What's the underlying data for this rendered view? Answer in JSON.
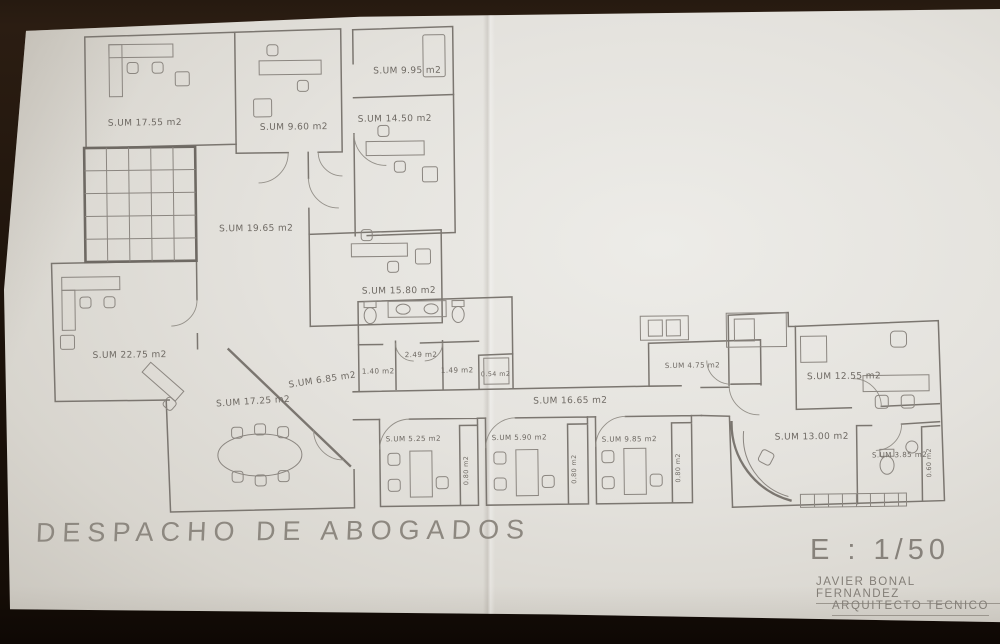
{
  "plan": {
    "title": "DESPACHO DE ABOGADOS",
    "scale": "E : 1/50",
    "author": "JAVIER BONAL FERNANDEZ",
    "author_title": "ARQUITECTO TECNICO",
    "line_color": "#7b7670",
    "paper_color": "#e4e2dd",
    "background_color": "#1d130b",
    "rooms": [
      {
        "id": "office-top-left",
        "label": "S.UM 17.55 m2"
      },
      {
        "id": "office-top-mid",
        "label": "S.UM 9.60 m2"
      },
      {
        "id": "office-top-right",
        "label": "S.UM 9.95 m2"
      },
      {
        "id": "office-mid-right",
        "label": "S.UM 14.50 m2"
      },
      {
        "id": "central-hall",
        "label": "S.UM 19.65 m2"
      },
      {
        "id": "office-center",
        "label": "S.UM 15.80 m2"
      },
      {
        "id": "office-left",
        "label": "S.UM 22.75 m2"
      },
      {
        "id": "meeting-room",
        "label": "S.UM 17.25 m2"
      },
      {
        "id": "small-office",
        "label": "S.UM 6.85 m2"
      },
      {
        "id": "wc-lobby",
        "label": "2.49 m2"
      },
      {
        "id": "wc-left",
        "label": "1.40 m2"
      },
      {
        "id": "wc-right",
        "label": "1.49 m2"
      },
      {
        "id": "closet",
        "label": "0.54 m2"
      },
      {
        "id": "corridor",
        "label": "S.UM 16.65 m2"
      },
      {
        "id": "cubicle-1",
        "label": "S.UM 5.25 m2"
      },
      {
        "id": "cubicle-1-closet",
        "label": "0.80 m2"
      },
      {
        "id": "cubicle-2",
        "label": "S.UM 5.90 m2"
      },
      {
        "id": "cubicle-2-closet",
        "label": "0.80 m2"
      },
      {
        "id": "cubicle-3",
        "label": "S.UM 9.85 m2"
      },
      {
        "id": "cubicle-3-closet",
        "label": "0.80 m2"
      },
      {
        "id": "storage",
        "label": "S.UM 4.75 m2"
      },
      {
        "id": "office-right",
        "label": "S.UM 12.55 m2"
      },
      {
        "id": "reception",
        "label": "S.UM 13.00 m2"
      },
      {
        "id": "wc-reception",
        "label": "S.UM 3.85 m2"
      },
      {
        "id": "reception-closet",
        "label": "0.60 m2"
      }
    ]
  }
}
